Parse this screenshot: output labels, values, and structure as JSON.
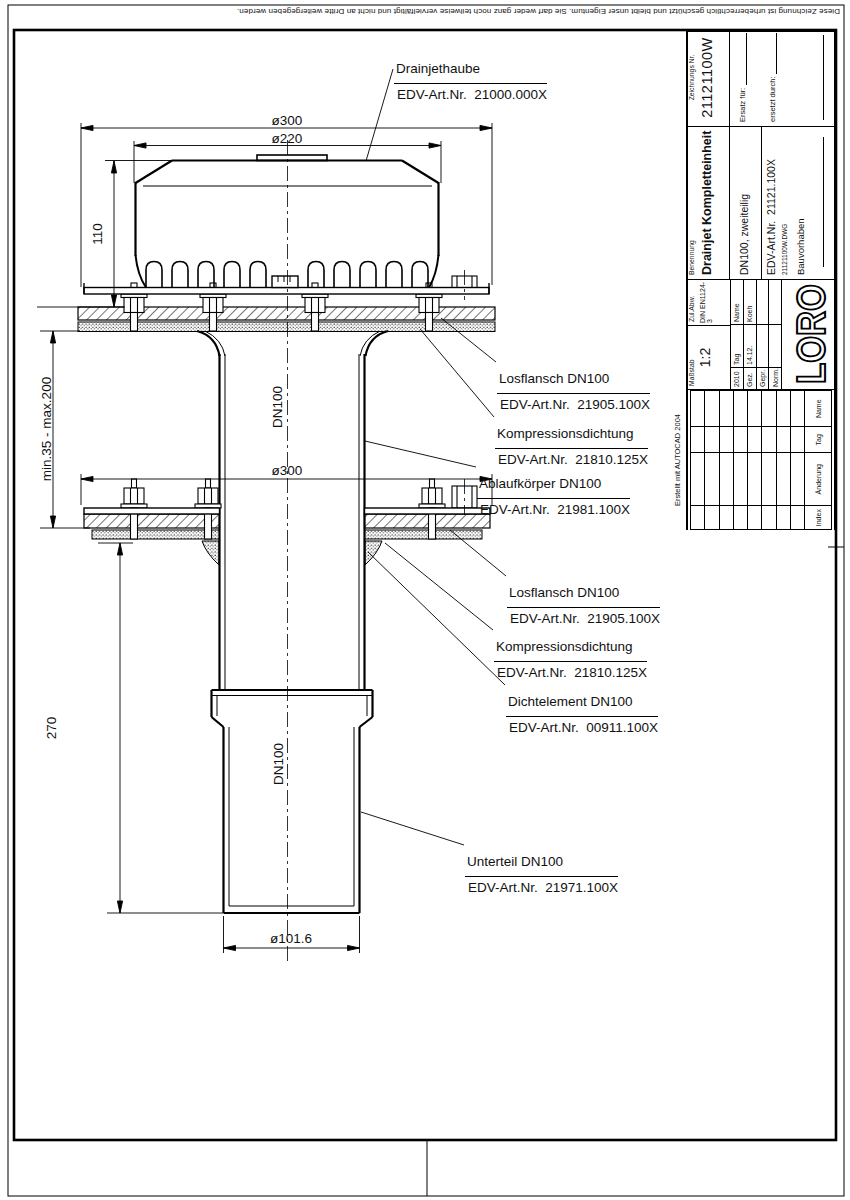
{
  "sheet": {
    "copyright": "Diese Zeichnung ist urheberrechtlich gesch\u00fctzt und bleibt unser Eigentum. Sie darf weder ganz noch teilweise vervielf\u00e4ltigt und nicht an Dritte weitergegeben werden.",
    "autocad_note": "Erstellt mit AUTOCAD 2004"
  },
  "dims": {
    "dia300_top": "\u00f8300",
    "dia220": "\u00f8220",
    "h110": "110",
    "adjust_range": "min.35 - max.200",
    "h270": "270",
    "dia300_mid": "\u00f8300",
    "dia101": "\u00f8101.6",
    "dn100_upper": "DN100",
    "dn100_lower": "DN100"
  },
  "parts": [
    {
      "line1": "Drainjethaube",
      "line2": "EDV-Art.Nr.  21000.000X"
    },
    {
      "line1": "Losflansch DN100",
      "line2": "EDV-Art.Nr.  21905.100X"
    },
    {
      "line1": "Kompressionsdichtung",
      "line2": "EDV-Art.Nr.  21810.125X"
    },
    {
      "line1": "Ablaufk\u00f6rper DN100",
      "line2": "EDV-Art.Nr.  21981.100X"
    },
    {
      "line1": "Losflansch DN100",
      "line2": "EDV-Art.Nr.  21905.100X"
    },
    {
      "line1": "Kompressionsdichtung",
      "line2": "EDV-Art.Nr.  21810.125X"
    },
    {
      "line1": "Dichtelement DN100",
      "line2": "EDV-Art.Nr.  00911.100X"
    },
    {
      "line1": "Unterteil DN100",
      "line2": "EDV-Art.Nr.  21971.100X"
    }
  ],
  "titleblock": {
    "zeichnungs_nr_label": "Zeichnungs Nr.",
    "zeichnungs_nr": "21121100W",
    "ersatz_fuer": "Ersatz f\u00fcr:",
    "ersetzt_durch": "ersetzt durch:",
    "benennung_label": "Benennung",
    "benennung": "Drainjet Kompletteinheit",
    "variante": "DN100, zweiteilig",
    "edv": "EDV-Art.Nr.  21121.100X",
    "dwg_file": "21121100W.DWG",
    "bauvorhaben": "Bauvorhaben",
    "massstab_label": "Ma\u00dfstab",
    "massstab": "1:2",
    "zul_abw_label": "Zul.Abw.",
    "zul_abw": "DIN EN1124-3",
    "year": "2010",
    "tag_header": "Tag",
    "name_header": "Name",
    "gez_label": "Gez.",
    "gez_tag": "14.12.",
    "gez_name": "Koeh",
    "gepr_label": "Gepr.",
    "norm_label": "Norm.",
    "logo": "LORO",
    "rev_index": "Index",
    "rev_aenderung": "\u00c4nderung",
    "rev_tag": "Tag",
    "rev_name": "Name"
  }
}
